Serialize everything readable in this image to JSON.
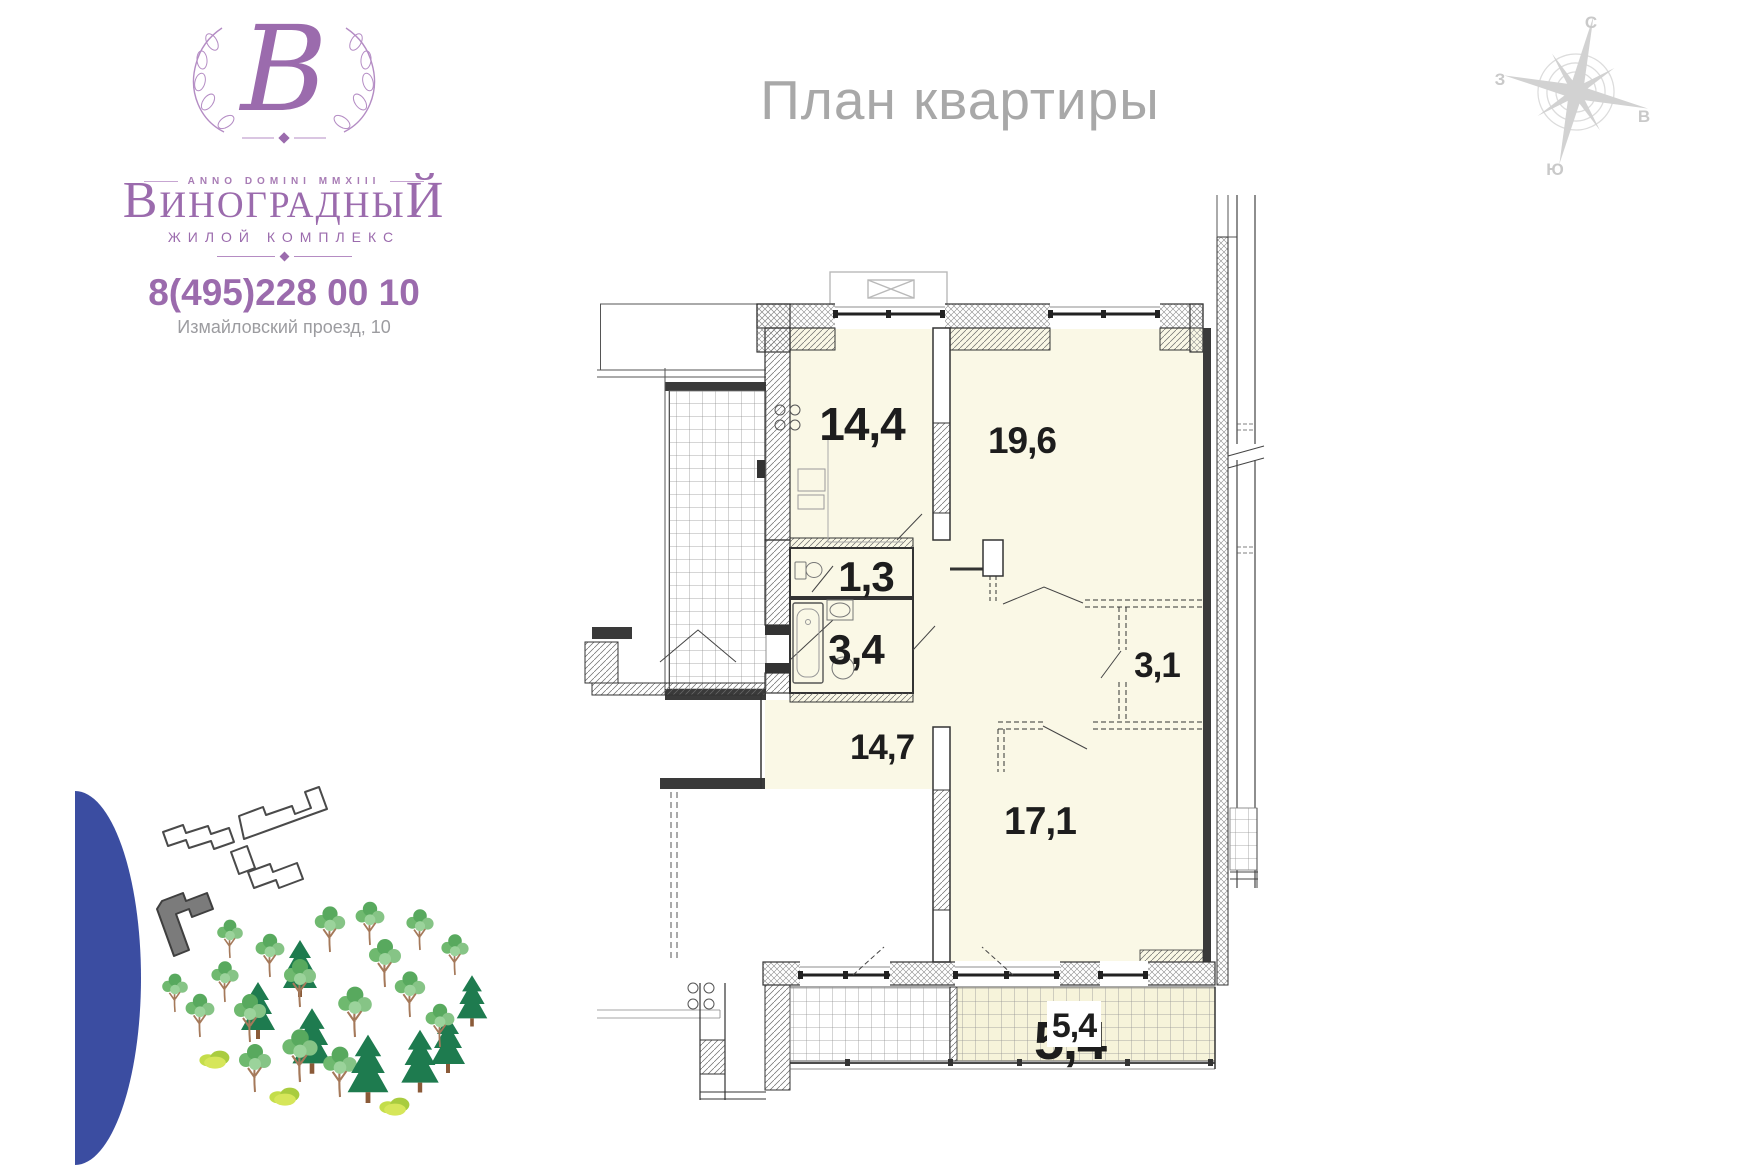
{
  "header": {
    "title": "План квартиры"
  },
  "logo": {
    "monogram": "В",
    "anno": "ANNO DOMINI MMXIII",
    "name_first": "В",
    "name_mid": "ИНОГРАДНЫ",
    "name_last": "Й",
    "subtitle": "ЖИЛОЙ КОМПЛЕКС",
    "phone": "8(495)228 00 10",
    "address": "Измайловский проезд, 10"
  },
  "compass": {
    "north": "С",
    "south": "Ю",
    "west": "З",
    "east": "В"
  },
  "plan": {
    "rooms": [
      {
        "name": "kitchen",
        "area_label": "14,4"
      },
      {
        "name": "living",
        "area_label": "19,6"
      },
      {
        "name": "wc",
        "area_label": "1,3"
      },
      {
        "name": "bathroom",
        "area_label": "3,4"
      },
      {
        "name": "wardrobe",
        "area_label": "3,1"
      },
      {
        "name": "hall",
        "area_label": "14,7"
      },
      {
        "name": "bedroom",
        "area_label": "17,1"
      },
      {
        "name": "balcony",
        "area_label": "5,4"
      }
    ],
    "balcony_overprint": "5,4"
  },
  "colors": {
    "brand_purple": "#9b6bad",
    "title_gray": "#a8a8a8",
    "room_fill": "#faf8e6",
    "balcony_fill": "#f6f3da",
    "blue_accent": "#3b4da1",
    "plan_line": "#333333",
    "compass_gray": "#d2d2d2",
    "building_gray": "#7b7b7b"
  }
}
